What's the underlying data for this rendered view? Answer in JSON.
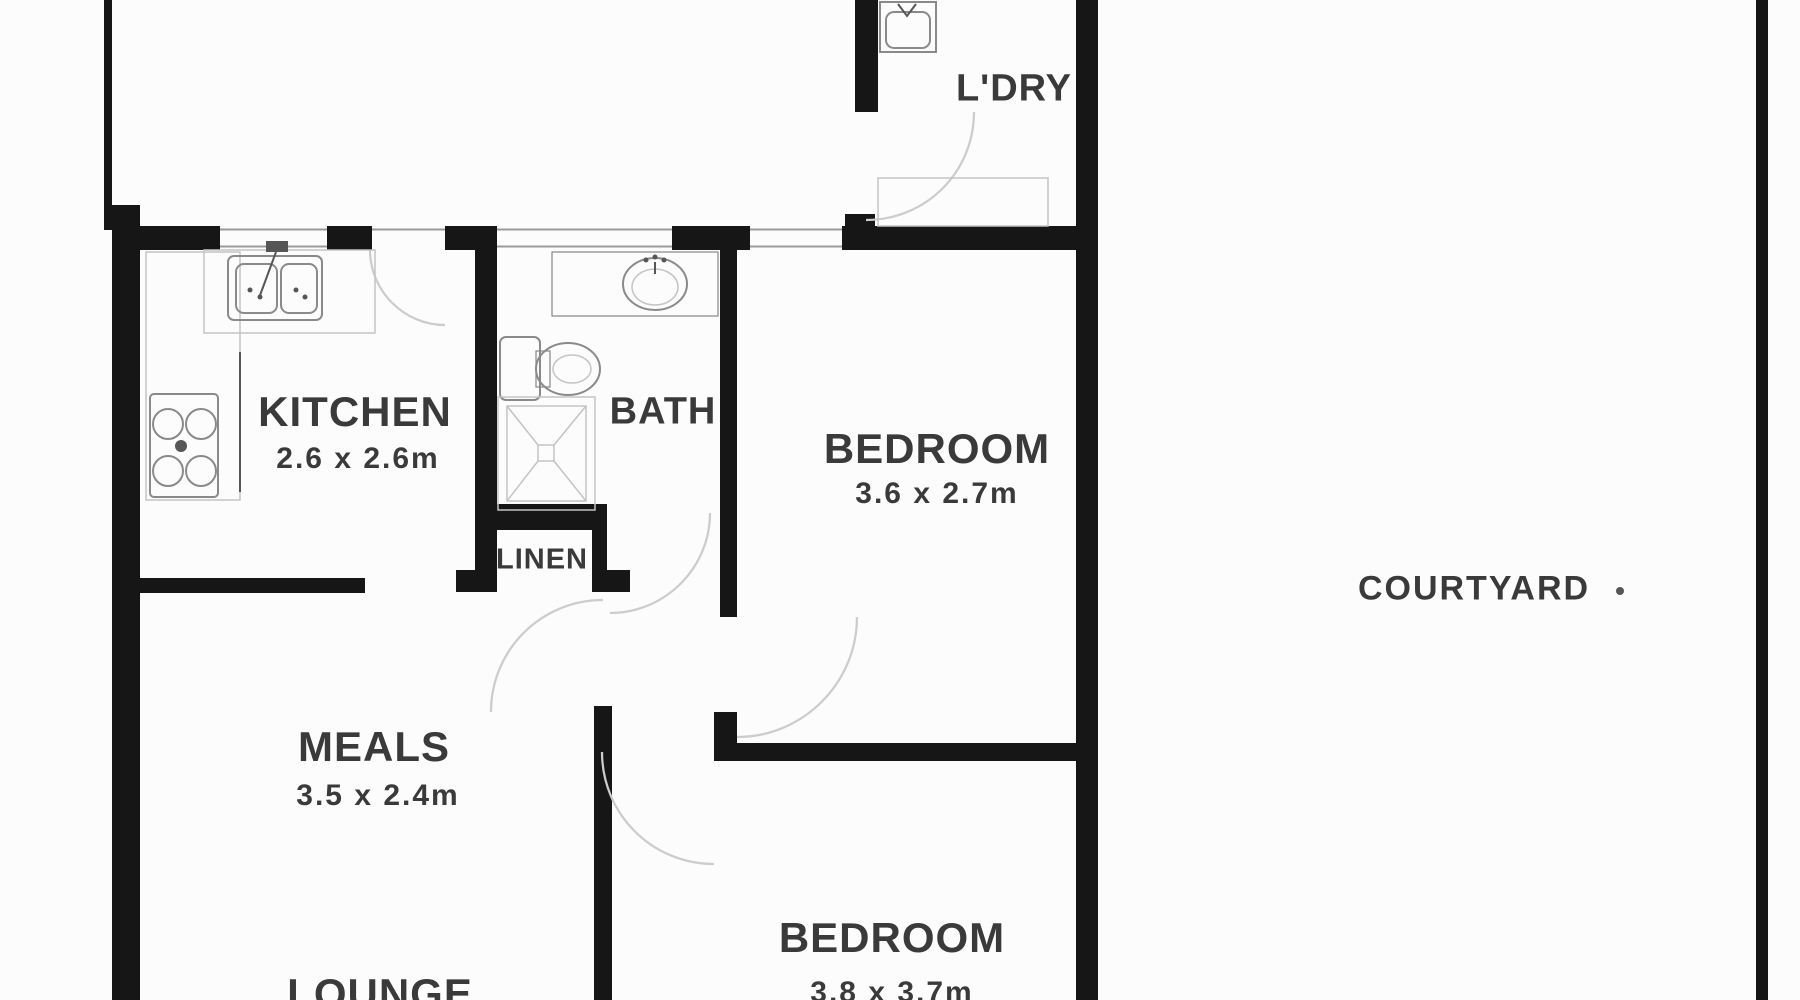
{
  "page": {
    "background": "#fcfcfc"
  },
  "colors": {
    "bg": "#fcfcfc",
    "wall": "#161616",
    "window_line": "#9a9a9a",
    "door_arc": "#cccccc",
    "fixture": "#8a8a8a",
    "fixture_light": "#c4c4c4",
    "fixture_dark": "#565656",
    "label": "#3a3a3a"
  },
  "rooms": {
    "kitchen": {
      "name": "KITCHEN",
      "dims": "2.6 x 2.6m"
    },
    "bath": {
      "name": "BATH"
    },
    "linen": {
      "name": "LINEN"
    },
    "bedroom1": {
      "name": "BEDROOM",
      "dims": "3.6 x 2.7m"
    },
    "meals": {
      "name": "MEALS",
      "dims": "3.5 x 2.4m"
    },
    "lounge": {
      "name": "LOUNGE"
    },
    "bedroom2": {
      "name": "BEDROOM",
      "dims": "3.8 x 3.7m"
    },
    "laundry": {
      "name": "L'DRY"
    },
    "courtyard": {
      "name": "COURTYARD"
    }
  }
}
